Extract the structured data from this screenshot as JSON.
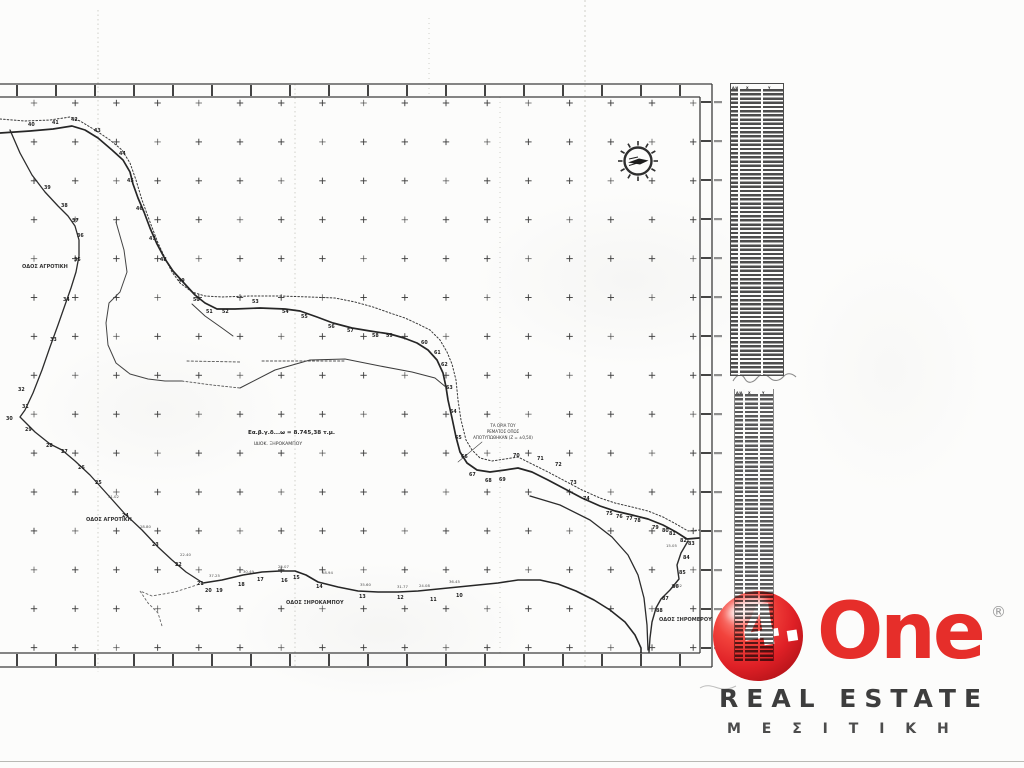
{
  "map": {
    "area_label": {
      "line1": "Εα.β.γ.δ...ω = 8.745,38 τ.μ.",
      "line2": "ΙΔΙΟΚ. ΞΗΡΟΚΑΜΠΟΥ"
    },
    "stream_note": {
      "line1": "ΤΑ ΟΡΙΑ ΤΟΥ",
      "line2": "ΡΕΜΑΤΟΣ ΟΠΩΣ",
      "line3": "ΑΠΟΤΥΠΩΘΗΚΑΝ (Ζ = ±0,50)"
    },
    "road_labels": [
      {
        "text": "ΟΔΟΣ ΑΓΡΟΤΙΚΗ",
        "x": 22,
        "y": 268
      },
      {
        "text": "ΟΔΟΣ ΑΓΡΟΤΙΚΗ",
        "x": 86,
        "y": 521
      },
      {
        "text": "ΟΔΟΣ ΞΗΡΟΚΑΜΠΟΥ",
        "x": 286,
        "y": 604
      },
      {
        "text": "ΟΔΟΣ ΞΗΡΟΜΕΡΟΥ",
        "x": 659,
        "y": 621
      }
    ],
    "vertex_numbers": [
      {
        "n": "40",
        "x": 28,
        "y": 126
      },
      {
        "n": "41",
        "x": 52,
        "y": 124
      },
      {
        "n": "42",
        "x": 71,
        "y": 121
      },
      {
        "n": "43",
        "x": 94,
        "y": 132
      },
      {
        "n": "44",
        "x": 119,
        "y": 155
      },
      {
        "n": "45",
        "x": 127,
        "y": 182
      },
      {
        "n": "46",
        "x": 136,
        "y": 210
      },
      {
        "n": "47",
        "x": 149,
        "y": 240
      },
      {
        "n": "48",
        "x": 160,
        "y": 261
      },
      {
        "n": "49",
        "x": 178,
        "y": 282
      },
      {
        "n": "50",
        "x": 193,
        "y": 301
      },
      {
        "n": "51",
        "x": 206,
        "y": 313
      },
      {
        "n": "52",
        "x": 222,
        "y": 313
      },
      {
        "n": "53",
        "x": 252,
        "y": 303
      },
      {
        "n": "54",
        "x": 282,
        "y": 313
      },
      {
        "n": "55",
        "x": 301,
        "y": 318
      },
      {
        "n": "56",
        "x": 328,
        "y": 328
      },
      {
        "n": "57",
        "x": 347,
        "y": 332
      },
      {
        "n": "58",
        "x": 372,
        "y": 337
      },
      {
        "n": "59",
        "x": 386,
        "y": 337
      },
      {
        "n": "60",
        "x": 421,
        "y": 344
      },
      {
        "n": "61",
        "x": 434,
        "y": 354
      },
      {
        "n": "62",
        "x": 441,
        "y": 366
      },
      {
        "n": "63",
        "x": 446,
        "y": 389
      },
      {
        "n": "64",
        "x": 450,
        "y": 413
      },
      {
        "n": "65",
        "x": 455,
        "y": 439
      },
      {
        "n": "66",
        "x": 461,
        "y": 458
      },
      {
        "n": "67",
        "x": 469,
        "y": 476
      },
      {
        "n": "68",
        "x": 485,
        "y": 482
      },
      {
        "n": "69",
        "x": 499,
        "y": 481
      },
      {
        "n": "70",
        "x": 513,
        "y": 457
      },
      {
        "n": "71",
        "x": 537,
        "y": 460
      },
      {
        "n": "72",
        "x": 555,
        "y": 466
      },
      {
        "n": "73",
        "x": 570,
        "y": 484
      },
      {
        "n": "74",
        "x": 583,
        "y": 500
      },
      {
        "n": "75",
        "x": 606,
        "y": 515
      },
      {
        "n": "76",
        "x": 616,
        "y": 518
      },
      {
        "n": "77",
        "x": 626,
        "y": 520
      },
      {
        "n": "78",
        "x": 634,
        "y": 522
      },
      {
        "n": "79",
        "x": 652,
        "y": 529
      },
      {
        "n": "80",
        "x": 662,
        "y": 532
      },
      {
        "n": "81",
        "x": 669,
        "y": 535
      },
      {
        "n": "82",
        "x": 680,
        "y": 542
      },
      {
        "n": "83",
        "x": 688,
        "y": 545
      },
      {
        "n": "84",
        "x": 683,
        "y": 559
      },
      {
        "n": "85",
        "x": 679,
        "y": 574
      },
      {
        "n": "86",
        "x": 672,
        "y": 588
      },
      {
        "n": "87",
        "x": 662,
        "y": 600
      },
      {
        "n": "88",
        "x": 656,
        "y": 612
      },
      {
        "n": "39",
        "x": 44,
        "y": 189
      },
      {
        "n": "38",
        "x": 61,
        "y": 207
      },
      {
        "n": "37",
        "x": 72,
        "y": 222
      },
      {
        "n": "36",
        "x": 77,
        "y": 237
      },
      {
        "n": "35",
        "x": 74,
        "y": 261
      },
      {
        "n": "34",
        "x": 63,
        "y": 301
      },
      {
        "n": "33",
        "x": 50,
        "y": 341
      },
      {
        "n": "32",
        "x": 18,
        "y": 391
      },
      {
        "n": "31",
        "x": 22,
        "y": 408
      },
      {
        "n": "30",
        "x": 6,
        "y": 420
      },
      {
        "n": "29",
        "x": 25,
        "y": 431
      },
      {
        "n": "28",
        "x": 46,
        "y": 447
      },
      {
        "n": "27",
        "x": 61,
        "y": 453
      },
      {
        "n": "26",
        "x": 78,
        "y": 469
      },
      {
        "n": "25",
        "x": 95,
        "y": 484
      },
      {
        "n": "24",
        "x": 122,
        "y": 517
      },
      {
        "n": "23",
        "x": 152,
        "y": 546
      },
      {
        "n": "22",
        "x": 175,
        "y": 566
      },
      {
        "n": "21",
        "x": 197,
        "y": 585
      },
      {
        "n": "20",
        "x": 205,
        "y": 592
      },
      {
        "n": "19",
        "x": 216,
        "y": 592
      },
      {
        "n": "18",
        "x": 238,
        "y": 586
      },
      {
        "n": "17",
        "x": 257,
        "y": 581
      },
      {
        "n": "16",
        "x": 281,
        "y": 582
      },
      {
        "n": "15",
        "x": 293,
        "y": 579
      },
      {
        "n": "14",
        "x": 316,
        "y": 588
      },
      {
        "n": "13",
        "x": 359,
        "y": 598
      },
      {
        "n": "12",
        "x": 397,
        "y": 599
      },
      {
        "n": "11",
        "x": 430,
        "y": 601
      },
      {
        "n": "10",
        "x": 456,
        "y": 597
      }
    ],
    "edge_lengths": [
      {
        "t": "22.40",
        "x": 180,
        "y": 556
      },
      {
        "t": "37.25",
        "x": 209,
        "y": 577
      },
      {
        "t": "30.49",
        "x": 243,
        "y": 573
      },
      {
        "t": "25.07",
        "x": 278,
        "y": 568
      },
      {
        "t": "28.94",
        "x": 322,
        "y": 574
      },
      {
        "t": "35.60",
        "x": 360,
        "y": 586
      },
      {
        "t": "31.77",
        "x": 397,
        "y": 588
      },
      {
        "t": "24.08",
        "x": 419,
        "y": 587
      },
      {
        "t": "36.45",
        "x": 449,
        "y": 583
      },
      {
        "t": "28.80",
        "x": 140,
        "y": 528
      },
      {
        "t": "31.02",
        "x": 108,
        "y": 498
      },
      {
        "t": "15.05",
        "x": 666,
        "y": 547
      },
      {
        "t": "12.92",
        "x": 671,
        "y": 587
      }
    ],
    "compass": {
      "x": 638,
      "y": 161
    }
  },
  "tables": {
    "table1": {
      "headers": [
        "Α/Α",
        "Χ",
        "Υ"
      ],
      "row_count": 69
    },
    "table2": {
      "headers": [
        "Α/Α",
        "Χ",
        "Υ"
      ],
      "row_count": 64
    }
  },
  "logo": {
    "ball_glyph": "4.",
    "brand": "One",
    "registered": "®",
    "subtitle": "REAL ESTATE",
    "subtitle_greek": "Μ Ε Σ Ι Τ Ι Κ Η",
    "colors": {
      "red": "#e62e2a",
      "dark": "#3d3d3d"
    }
  }
}
